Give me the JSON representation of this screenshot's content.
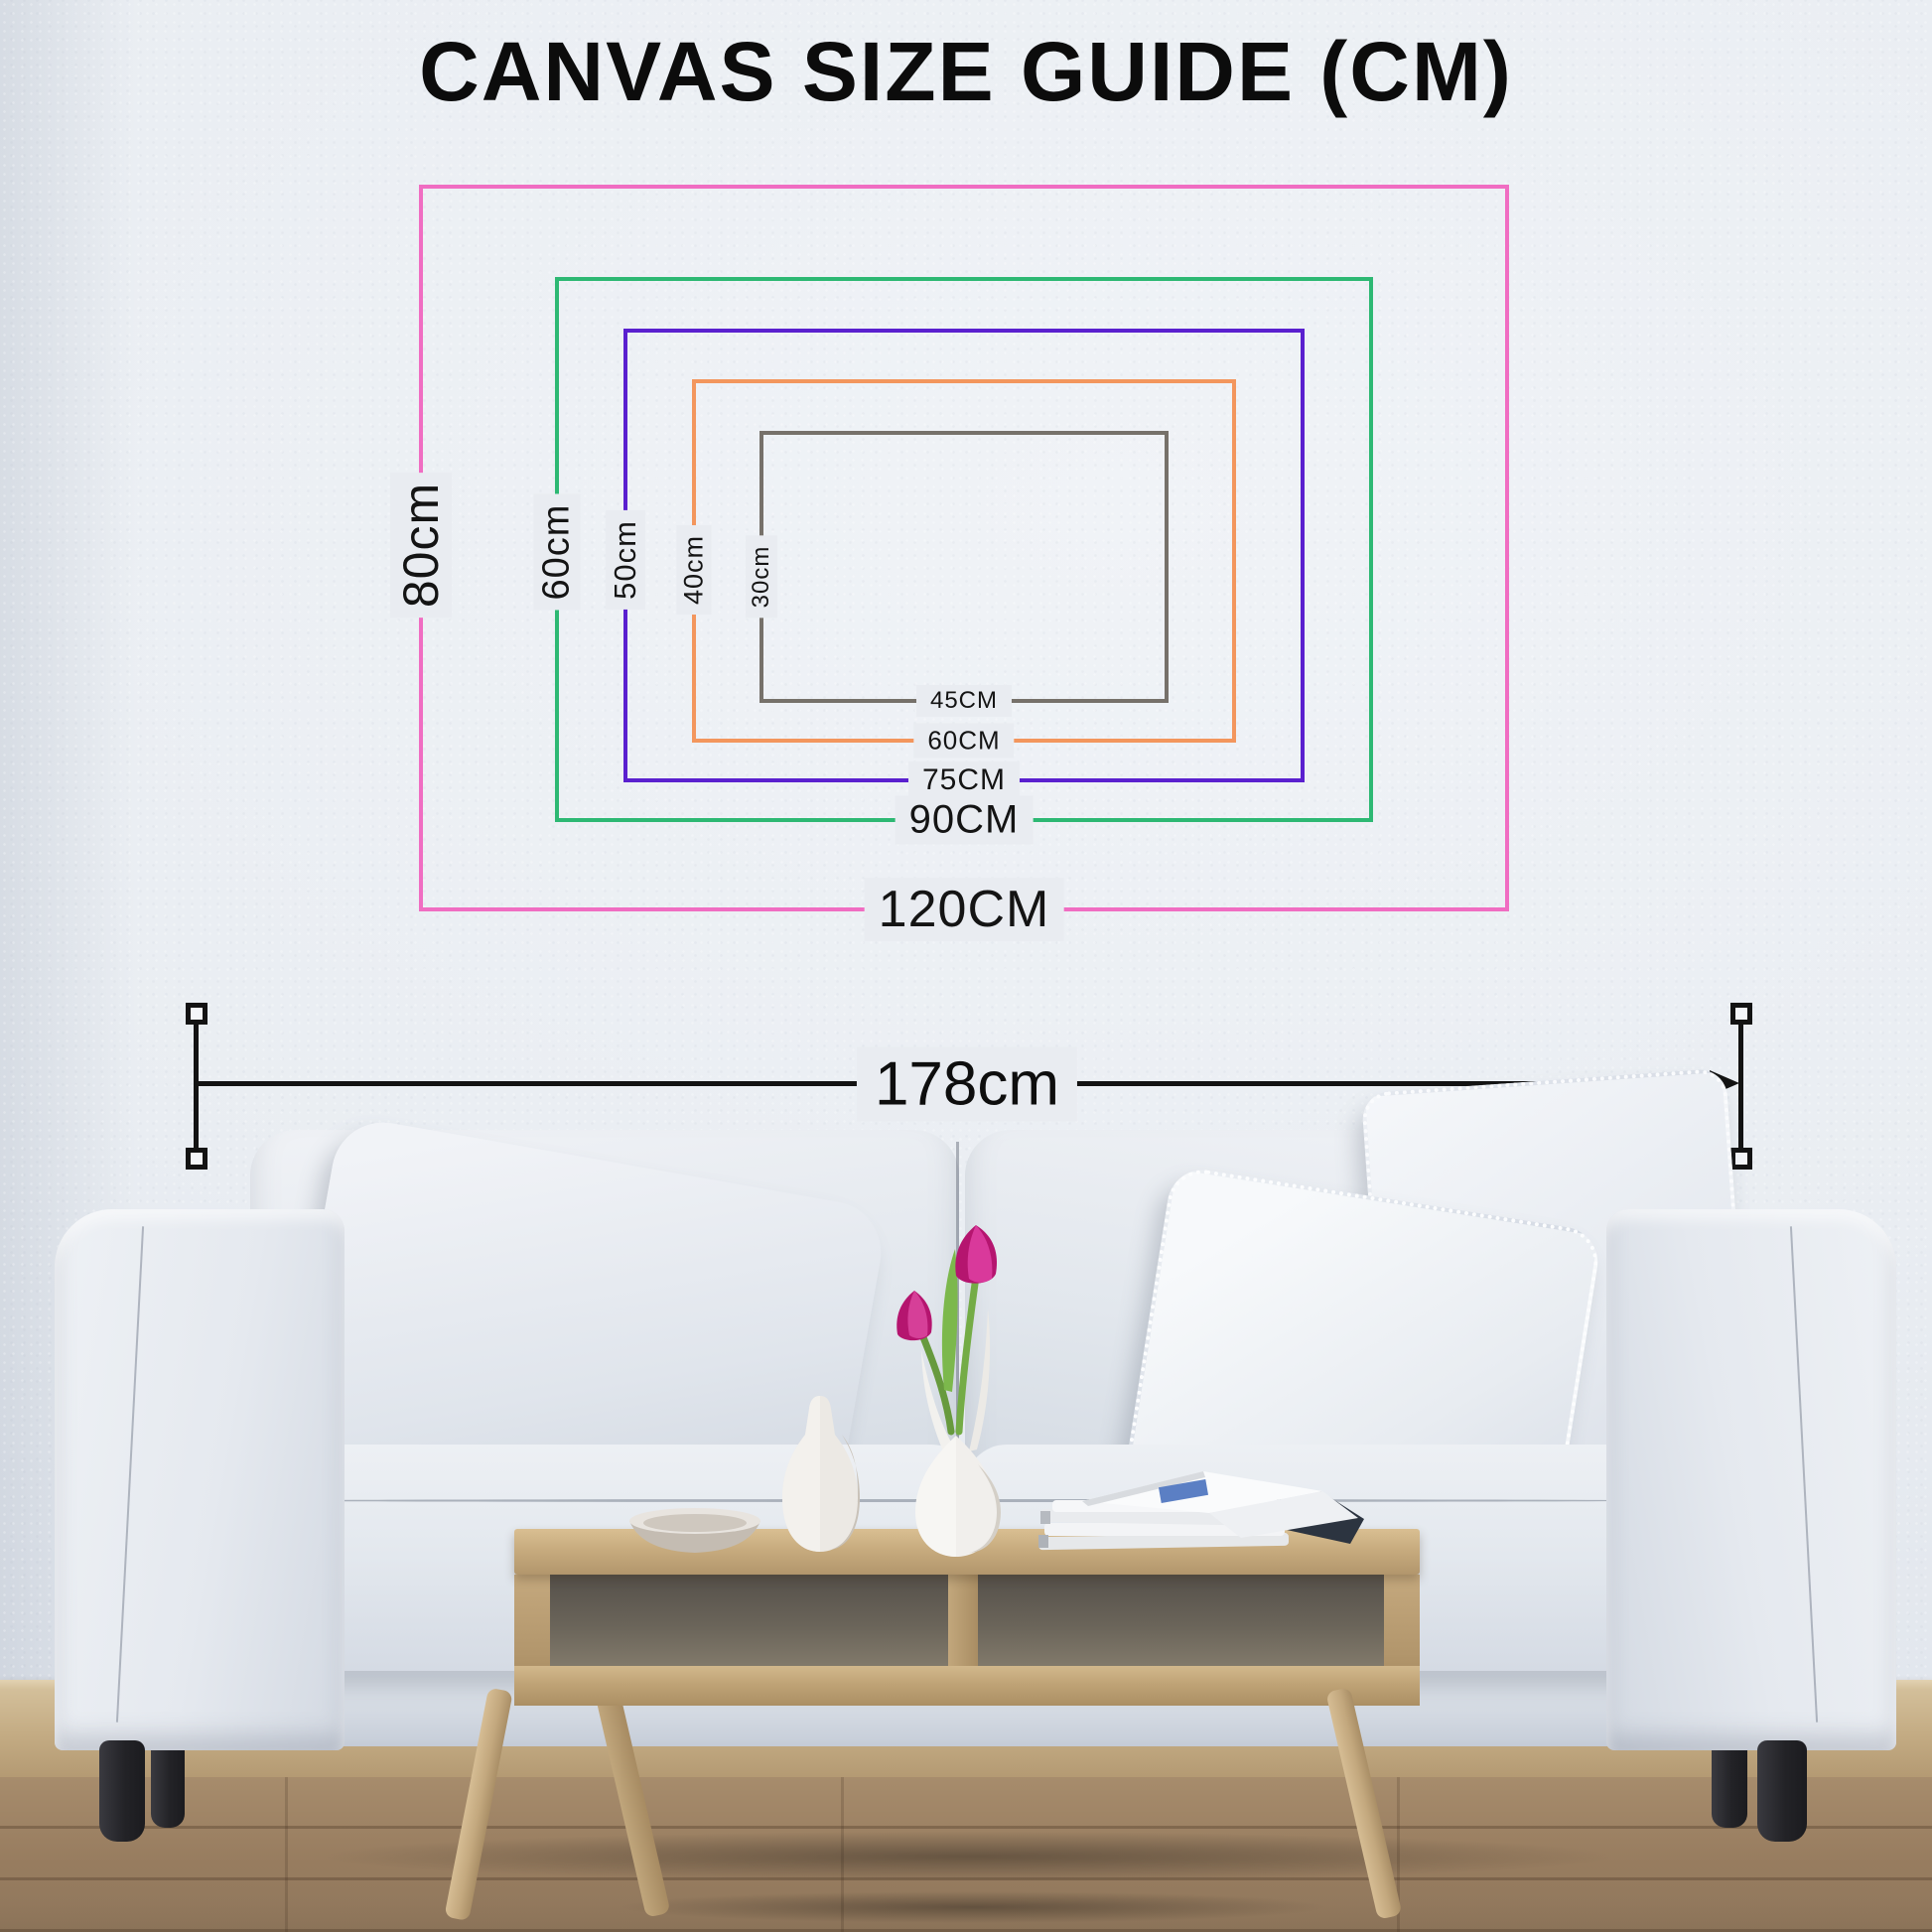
{
  "title": "CANVAS SIZE GUIDE (CM)",
  "canvases": [
    {
      "id": "120x80",
      "width_cm": 120,
      "height_cm": 80,
      "width_label": "120CM",
      "height_label": "80cm",
      "color": "#f06dc2"
    },
    {
      "id": "90x60",
      "width_cm": 90,
      "height_cm": 60,
      "width_label": "90CM",
      "height_label": "60cm",
      "color": "#2db873"
    },
    {
      "id": "75x50",
      "width_cm": 75,
      "height_cm": 50,
      "width_label": "75CM",
      "height_label": "50cm",
      "color": "#5a20cf"
    },
    {
      "id": "60x40",
      "width_cm": 60,
      "height_cm": 40,
      "width_label": "60CM",
      "height_label": "40cm",
      "color": "#f3965d"
    },
    {
      "id": "45x30",
      "width_cm": 45,
      "height_cm": 30,
      "width_label": "45CM",
      "height_label": "30cm",
      "color": "#76716a"
    }
  ],
  "measurement": {
    "label": "178cm"
  },
  "palette": {
    "wall": "#e9ecf1",
    "baseboard": "#c9b28e",
    "floor": "#9a8166",
    "sofa_fabric": "#e2e7ee",
    "table_wood": "#c2a67a",
    "sofa_leg": "#232327",
    "tulip": "#c0177d",
    "text": "#141414"
  }
}
